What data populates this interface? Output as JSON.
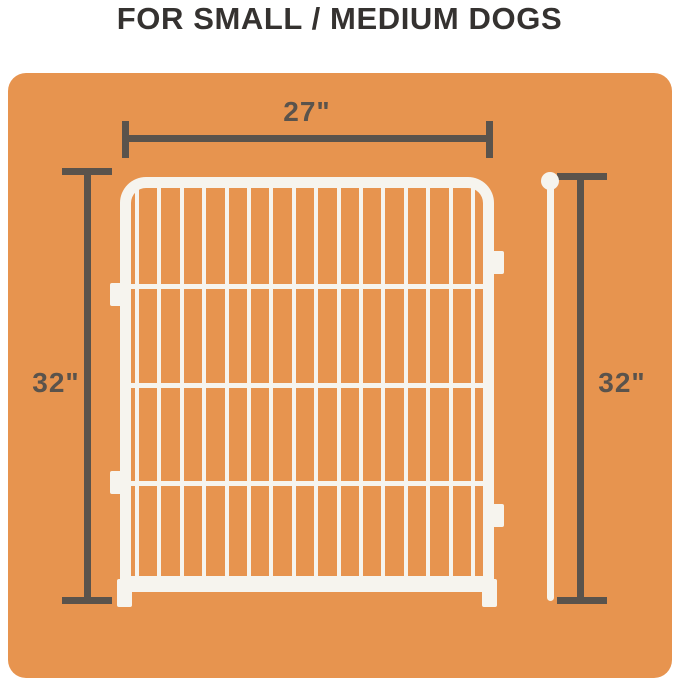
{
  "title": "FOR SMALL / MEDIUM DOGS",
  "colors": {
    "page_bg": "#FFFFFF",
    "panel_orange": "#E7944F",
    "dimension_gray": "#5A534C",
    "title_color": "#353230",
    "fence_white": "#F6F4EE"
  },
  "dimensions": {
    "top_width": "27\"",
    "left_height": "32\"",
    "right_height": "32\""
  },
  "fence": {
    "vertical_bars": 16,
    "horizontal_crossbars": 3
  }
}
